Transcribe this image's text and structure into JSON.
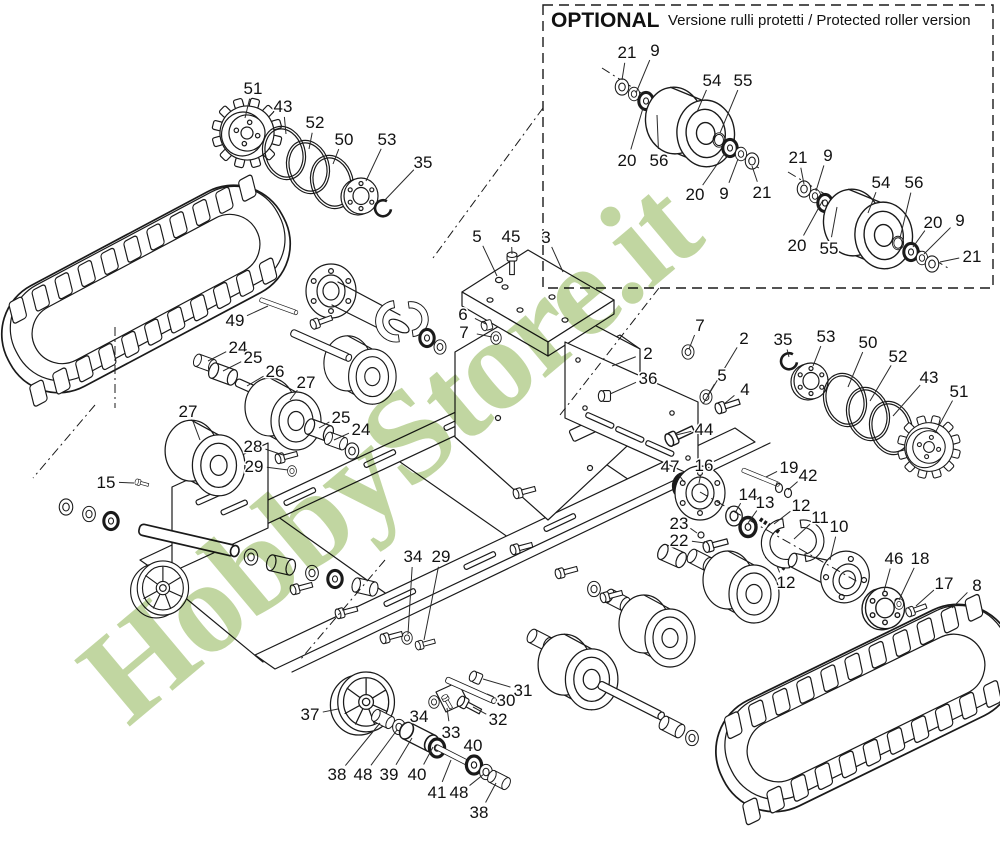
{
  "optional_box": {
    "title": "OPTIONAL",
    "subtitle": "Versione rulli protetti / Protected roller version"
  },
  "watermark": {
    "text": "HobbyStore.it",
    "color": "#b2cc8a"
  },
  "part_labels": [
    {
      "n": "51",
      "x": 253,
      "y": 88,
      "tx": 245,
      "ty": 118
    },
    {
      "n": "43",
      "x": 283,
      "y": 106,
      "tx": 286,
      "ty": 134
    },
    {
      "n": "52",
      "x": 315,
      "y": 122,
      "tx": 309,
      "ty": 149
    },
    {
      "n": "50",
      "x": 344,
      "y": 139,
      "tx": 333,
      "ty": 164
    },
    {
      "n": "53",
      "x": 387,
      "y": 139,
      "tx": 366,
      "ty": 181
    },
    {
      "n": "35",
      "x": 423,
      "y": 162,
      "tx": 384,
      "ty": 201
    },
    {
      "n": "21",
      "x": 627,
      "y": 52,
      "tx": 622,
      "ty": 80
    },
    {
      "n": "9",
      "x": 655,
      "y": 50,
      "tx": 636,
      "ty": 93
    },
    {
      "n": "54",
      "x": 712,
      "y": 80,
      "tx": 697,
      "ty": 112
    },
    {
      "n": "55",
      "x": 743,
      "y": 80,
      "tx": 720,
      "ty": 133
    },
    {
      "n": "20",
      "x": 627,
      "y": 160,
      "tx": 643,
      "ty": 108
    },
    {
      "n": "56",
      "x": 659,
      "y": 160,
      "tx": 657,
      "ty": 115
    },
    {
      "n": "20",
      "x": 695,
      "y": 194,
      "tx": 725,
      "ty": 153
    },
    {
      "n": "9",
      "x": 724,
      "y": 193,
      "tx": 738,
      "ty": 159
    },
    {
      "n": "21",
      "x": 762,
      "y": 192,
      "tx": 752,
      "ty": 166
    },
    {
      "n": "21",
      "x": 798,
      "y": 157,
      "tx": 804,
      "ty": 184
    },
    {
      "n": "9",
      "x": 828,
      "y": 155,
      "tx": 816,
      "ty": 191
    },
    {
      "n": "54",
      "x": 881,
      "y": 182,
      "tx": 868,
      "ty": 213
    },
    {
      "n": "56",
      "x": 914,
      "y": 182,
      "tx": 900,
      "ty": 238
    },
    {
      "n": "20",
      "x": 933,
      "y": 222,
      "tx": 913,
      "ty": 247
    },
    {
      "n": "9",
      "x": 960,
      "y": 220,
      "tx": 924,
      "ty": 254
    },
    {
      "n": "21",
      "x": 972,
      "y": 256,
      "tx": 940,
      "ty": 262
    },
    {
      "n": "20",
      "x": 797,
      "y": 245,
      "tx": 823,
      "ty": 200
    },
    {
      "n": "55",
      "x": 829,
      "y": 248,
      "tx": 837,
      "ty": 207
    },
    {
      "n": "5",
      "x": 477,
      "y": 236,
      "tx": 497,
      "ty": 276
    },
    {
      "n": "45",
      "x": 511,
      "y": 236,
      "tx": 512,
      "ty": 254
    },
    {
      "n": "3",
      "x": 546,
      "y": 237,
      "tx": 563,
      "ty": 272
    },
    {
      "n": "6",
      "x": 463,
      "y": 314,
      "tx": 486,
      "ty": 324
    },
    {
      "n": "7",
      "x": 464,
      "y": 332,
      "tx": 492,
      "ty": 337
    },
    {
      "n": "2",
      "x": 648,
      "y": 353,
      "tx": 612,
      "ty": 366
    },
    {
      "n": "36",
      "x": 648,
      "y": 378,
      "tx": 610,
      "ty": 394
    },
    {
      "n": "7",
      "x": 700,
      "y": 325,
      "tx": 689,
      "ty": 349
    },
    {
      "n": "2",
      "x": 744,
      "y": 338,
      "tx": 703,
      "ty": 404
    },
    {
      "n": "5",
      "x": 722,
      "y": 375,
      "tx": 708,
      "ty": 395
    },
    {
      "n": "4",
      "x": 745,
      "y": 389,
      "tx": 724,
      "ty": 404
    },
    {
      "n": "44",
      "x": 704,
      "y": 429,
      "tx": 676,
      "ty": 435
    },
    {
      "n": "49",
      "x": 235,
      "y": 320,
      "tx": 268,
      "ty": 306
    },
    {
      "n": "24",
      "x": 238,
      "y": 347,
      "tx": 208,
      "ty": 361
    },
    {
      "n": "25",
      "x": 253,
      "y": 357,
      "tx": 223,
      "ty": 371
    },
    {
      "n": "26",
      "x": 275,
      "y": 371,
      "tx": 247,
      "ty": 386
    },
    {
      "n": "27",
      "x": 306,
      "y": 382,
      "tx": 290,
      "ty": 400
    },
    {
      "n": "27",
      "x": 188,
      "y": 411,
      "tx": 200,
      "ty": 440
    },
    {
      "n": "25",
      "x": 341,
      "y": 417,
      "tx": 319,
      "ty": 428
    },
    {
      "n": "24",
      "x": 361,
      "y": 429,
      "tx": 334,
      "ty": 440
    },
    {
      "n": "28",
      "x": 253,
      "y": 446,
      "tx": 283,
      "ty": 455
    },
    {
      "n": "29",
      "x": 254,
      "y": 466,
      "tx": 288,
      "ty": 470
    },
    {
      "n": "15",
      "x": 106,
      "y": 482,
      "tx": 134,
      "ty": 483
    },
    {
      "n": "47",
      "x": 670,
      "y": 466,
      "tx": 684,
      "ty": 482
    },
    {
      "n": "16",
      "x": 704,
      "y": 465,
      "tx": 699,
      "ty": 483
    },
    {
      "n": "19",
      "x": 789,
      "y": 467,
      "tx": 766,
      "ty": 477
    },
    {
      "n": "42",
      "x": 808,
      "y": 475,
      "tx": 788,
      "ty": 490
    },
    {
      "n": "14",
      "x": 748,
      "y": 494,
      "tx": 735,
      "ty": 513
    },
    {
      "n": "13",
      "x": 765,
      "y": 502,
      "tx": 748,
      "ty": 523
    },
    {
      "n": "12",
      "x": 801,
      "y": 505,
      "tx": 774,
      "ty": 524
    },
    {
      "n": "11",
      "x": 820,
      "y": 517,
      "tx": 794,
      "ty": 539
    },
    {
      "n": "10",
      "x": 839,
      "y": 526,
      "tx": 830,
      "ty": 560
    },
    {
      "n": "23",
      "x": 679,
      "y": 523,
      "tx": 697,
      "ty": 533
    },
    {
      "n": "22",
      "x": 679,
      "y": 540,
      "tx": 705,
      "ty": 543
    },
    {
      "n": "12",
      "x": 786,
      "y": 582,
      "tx": 777,
      "ty": 566
    },
    {
      "n": "35",
      "x": 783,
      "y": 339,
      "tx": 789,
      "ty": 357
    },
    {
      "n": "53",
      "x": 826,
      "y": 336,
      "tx": 813,
      "ty": 366
    },
    {
      "n": "50",
      "x": 868,
      "y": 342,
      "tx": 848,
      "ty": 387
    },
    {
      "n": "52",
      "x": 898,
      "y": 356,
      "tx": 870,
      "ty": 401
    },
    {
      "n": "43",
      "x": 929,
      "y": 377,
      "tx": 893,
      "ty": 416
    },
    {
      "n": "51",
      "x": 959,
      "y": 391,
      "tx": 935,
      "ty": 433
    },
    {
      "n": "46",
      "x": 894,
      "y": 558,
      "tx": 884,
      "ty": 591
    },
    {
      "n": "18",
      "x": 920,
      "y": 558,
      "tx": 899,
      "ty": 600
    },
    {
      "n": "17",
      "x": 944,
      "y": 583,
      "tx": 916,
      "ty": 606
    },
    {
      "n": "8",
      "x": 977,
      "y": 585,
      "tx": 952,
      "ty": 608
    },
    {
      "n": "34",
      "x": 413,
      "y": 556,
      "tx": 408,
      "ty": 634
    },
    {
      "n": "29",
      "x": 441,
      "y": 556,
      "tx": 424,
      "ty": 640
    },
    {
      "n": "37",
      "x": 310,
      "y": 714,
      "tx": 338,
      "ty": 709
    },
    {
      "n": "38",
      "x": 337,
      "y": 774,
      "tx": 380,
      "ty": 723
    },
    {
      "n": "48",
      "x": 363,
      "y": 774,
      "tx": 397,
      "ty": 730
    },
    {
      "n": "39",
      "x": 389,
      "y": 774,
      "tx": 412,
      "ty": 738
    },
    {
      "n": "40",
      "x": 417,
      "y": 774,
      "tx": 433,
      "ty": 747
    },
    {
      "n": "40",
      "x": 473,
      "y": 745,
      "tx": 473,
      "ty": 761
    },
    {
      "n": "41",
      "x": 437,
      "y": 792,
      "tx": 451,
      "ty": 760
    },
    {
      "n": "48",
      "x": 459,
      "y": 792,
      "tx": 484,
      "ty": 774
    },
    {
      "n": "38",
      "x": 479,
      "y": 812,
      "tx": 496,
      "ty": 783
    },
    {
      "n": "34",
      "x": 419,
      "y": 716,
      "tx": 432,
      "ty": 704
    },
    {
      "n": "33",
      "x": 451,
      "y": 732,
      "tx": 447,
      "ty": 708
    },
    {
      "n": "30",
      "x": 506,
      "y": 700,
      "tx": 487,
      "ty": 694
    },
    {
      "n": "31",
      "x": 523,
      "y": 690,
      "tx": 483,
      "ty": 679
    },
    {
      "n": "32",
      "x": 498,
      "y": 719,
      "tx": 473,
      "ty": 707
    }
  ]
}
